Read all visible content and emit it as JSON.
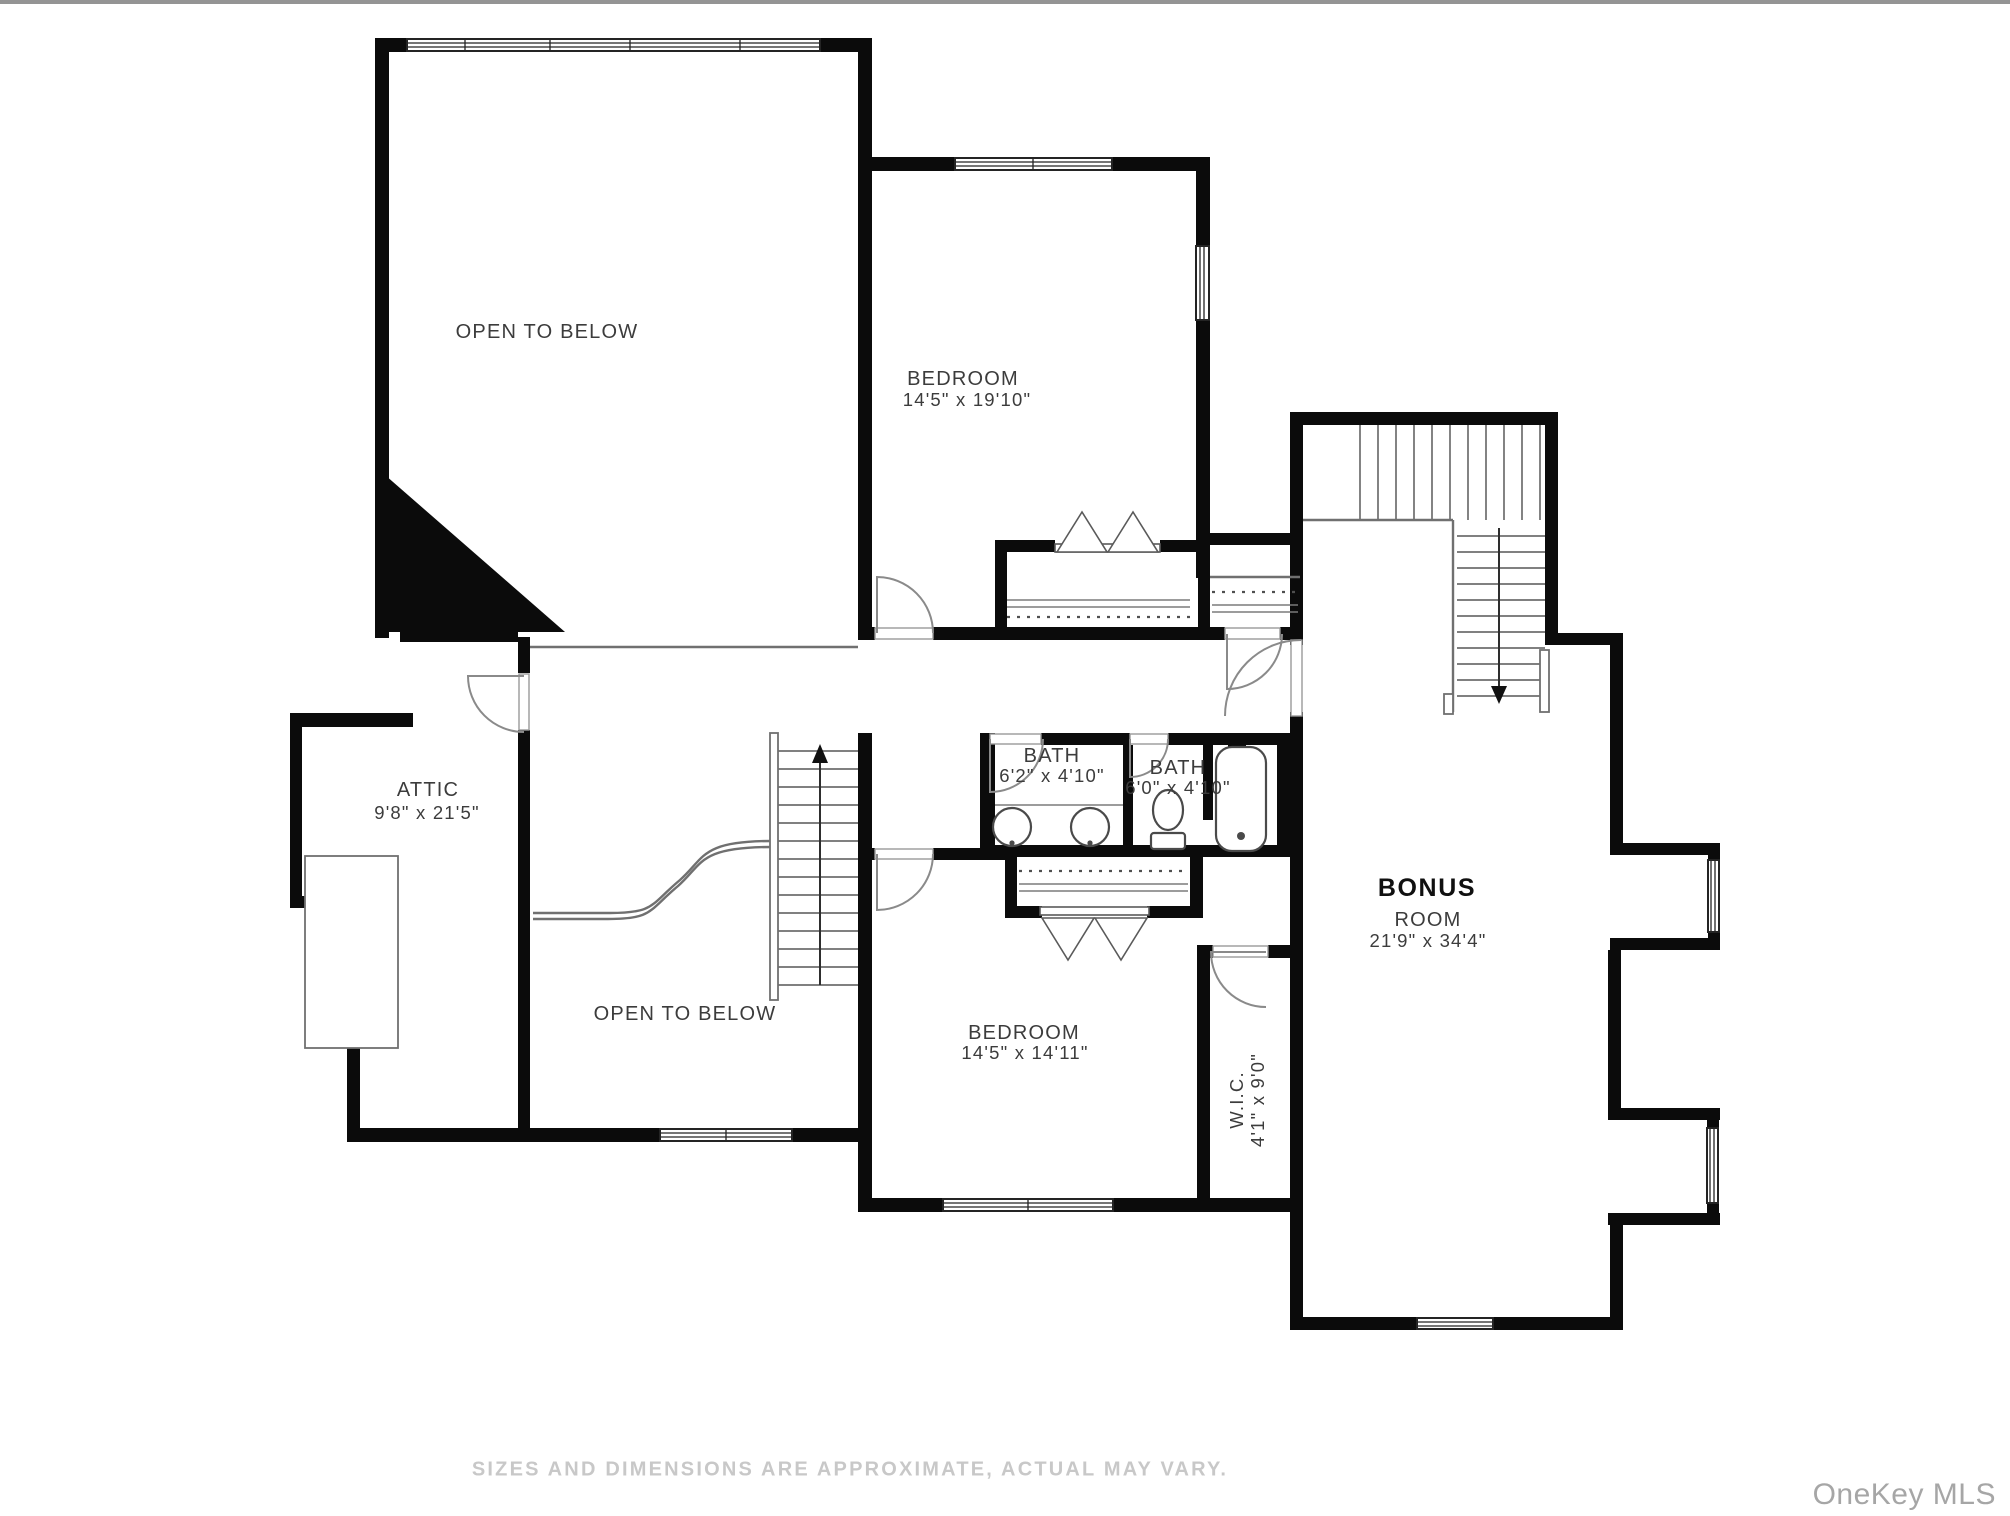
{
  "floorplan": {
    "labels": {
      "open_to_below_top": "OPEN TO BELOW",
      "open_to_below_bottom": "OPEN TO BELOW",
      "bedroom_top": {
        "name": "BEDROOM",
        "dims": "14'5\" x 19'10\""
      },
      "attic": {
        "name": "ATTIC",
        "dims": "9'8\" x 21'5\""
      },
      "bath_left": {
        "name": "BATH",
        "dims": "6'2\" x 4'10\""
      },
      "bath_right": {
        "name": "BATH",
        "dims": "6'0\" x 4'10\""
      },
      "bonus": {
        "name_line1": "BONUS",
        "name_line2": "ROOM",
        "dims": "21'9\" x 34'4\""
      },
      "bedroom_bottom": {
        "name": "BEDROOM",
        "dims": "14'5\" x 14'11\""
      },
      "wic": {
        "name": "W.I.C.",
        "dims": "4'1\" x 9'0\""
      }
    },
    "stairs": {
      "up_arrow": "up",
      "down_arrow": "down"
    },
    "colors": {
      "wall": "#0b0b0b",
      "thin": "#707070",
      "door": "#8a8a8a",
      "label": "#3c3c3c",
      "bonus": "#101010",
      "disclaimer": "#c8c8c8",
      "watermark": "#a6a6a6",
      "topline": "#949494"
    }
  },
  "footer": {
    "disclaimer": "SIZES AND DIMENSIONS ARE APPROXIMATE, ACTUAL MAY VARY.",
    "watermark": "OneKey MLS"
  }
}
